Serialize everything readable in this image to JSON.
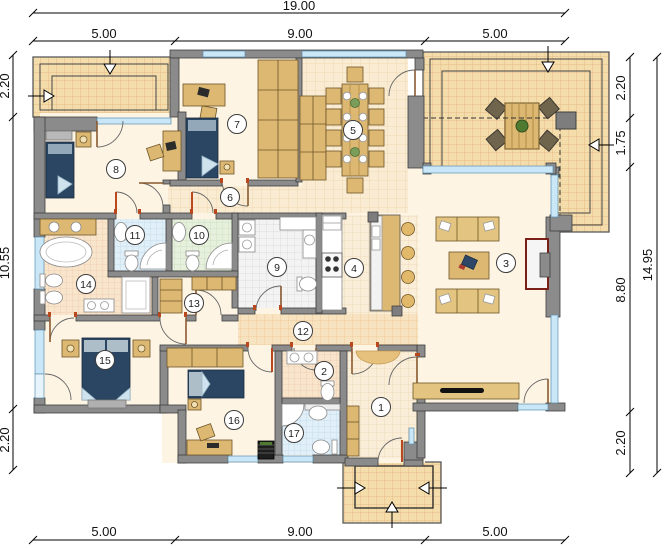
{
  "plan": {
    "type": "architectural-floor-plan",
    "rooms": [
      "1",
      "2",
      "3",
      "4",
      "5",
      "6",
      "7",
      "8",
      "9",
      "10",
      "11",
      "12",
      "13",
      "14",
      "15",
      "16",
      "17"
    ],
    "dimensions": {
      "top_total": "19.00",
      "top_segments": [
        "5.00",
        "9.00",
        "5.00"
      ],
      "bottom_segments": [
        "5.00",
        "9.00",
        "5.00"
      ],
      "left_segments": [
        "2.20",
        "10.55",
        "2.20"
      ],
      "right_segments": [
        "2.20",
        "1.75",
        "8.80",
        "2.20"
      ],
      "right_total": "14.95"
    },
    "colors": {
      "wall": "#8b8b8b",
      "floor": "#fdf4e3",
      "terrace_tile": "#f5dcab",
      "window": "#c9e7f7",
      "bed": "#2a4663",
      "furniture": "#dcb873",
      "door_mark": "#b9481f",
      "dimension_text": "#111111"
    }
  }
}
